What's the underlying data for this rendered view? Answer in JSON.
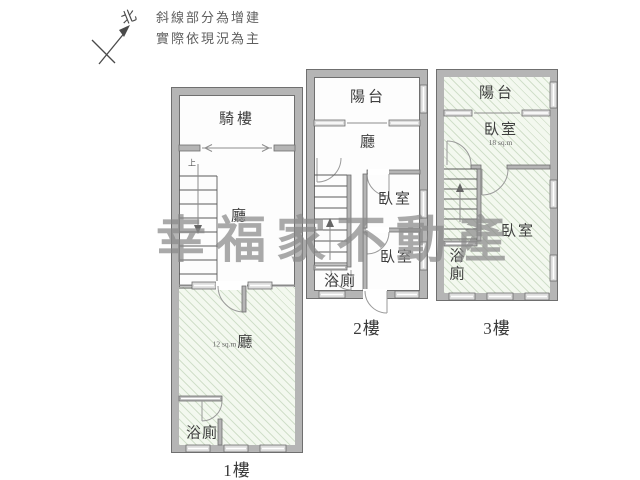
{
  "note": {
    "line1": "斜線部分為增建",
    "line2": "實際依現況為主"
  },
  "compass": {
    "north_label": "北"
  },
  "watermark": {
    "text": "幸福家不動產"
  },
  "colors": {
    "wall_fill": "#b5b5b5",
    "wall_outline": "#6f6f6f",
    "hatch_background": "#f3f8ef",
    "hatch_line": "#82a573",
    "watermark_gray": "#8a8a8a",
    "label_gray": "#3f3f3f"
  },
  "floors": {
    "f1": {
      "label": "1樓",
      "arcade": "騎樓",
      "hall": "廳",
      "stairs_up": "上",
      "annex_area": "12 sq.m",
      "annex_hall": "廳",
      "bath": "浴廁"
    },
    "f2": {
      "label": "2樓",
      "balcony": "陽台",
      "hall": "廳",
      "bedroom_upper": "臥室",
      "bedroom_lower": "臥室",
      "bath": "浴廁"
    },
    "f3": {
      "label": "3樓",
      "balcony": "陽台",
      "bedroom_upper": "臥室",
      "bedroom_upper_area": "18 sq.m",
      "bedroom_lower": "臥室",
      "bath_char1": "浴",
      "bath_char2": "廁"
    }
  }
}
